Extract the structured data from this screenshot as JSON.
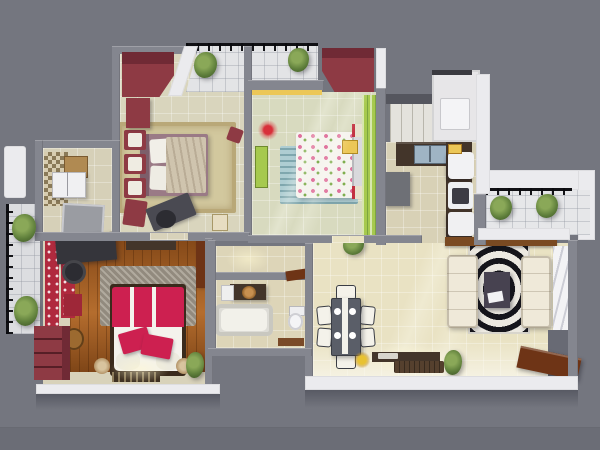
{
  "scene": {
    "title": "3D rendered top-down floor plan of a three-bedroom apartment",
    "background": "#74767f",
    "wall": "#84868f",
    "wall_white": "#ebebee",
    "rooms": {
      "bedroom1": {
        "label": "bedroom-1",
        "floor": "#d9d5bd",
        "furniture": [
          "maroon wardrobe",
          "double bed with beige patterned duvet",
          "floral rug",
          "accent chairs",
          "desk with office chair",
          "maroon cabinet"
        ]
      },
      "bedroom2": {
        "label": "bedroom-2",
        "floor": "#d8dabf",
        "furniture": [
          "maroon wardrobe",
          "white bed with pink flower print",
          "blue striped rug",
          "green bench",
          "green striped wardrobe",
          "nightstands",
          "yellow tray"
        ]
      },
      "kitchen": {
        "label": "kitchen",
        "floor": "#d8d1b6",
        "furniture": [
          "dark L-shaped counter",
          "double sink",
          "fridge",
          "oven",
          "cabinet",
          "grey table"
        ]
      },
      "utility": {
        "label": "utility-room",
        "floor": "#e7e6e8",
        "furniture": [
          "washing machine"
        ]
      },
      "foyer": {
        "label": "foyer-bathroom",
        "floor": "#d6d0b8",
        "furniture": [
          "mosaic wall",
          "white vanity",
          "wood cabinet",
          "shower tray"
        ]
      },
      "master": {
        "label": "master-bedroom",
        "floor": "#d8d2ba",
        "wood": "#a2591e",
        "furniture": [
          "red double bed",
          "grey shag rug",
          "maroon dresser",
          "wall TV panel",
          "red curtain panels",
          "log stools",
          "doormat",
          "plant"
        ]
      },
      "bathroom": {
        "label": "bathroom",
        "floor": "#ddd5b8",
        "furniture": [
          "bathtub",
          "toilet",
          "vanity with round basin",
          "brown mat"
        ]
      },
      "living": {
        "label": "living-dining",
        "floor": "#e9e2c3",
        "furniture": [
          "dining table with six chairs",
          "two cream sofas",
          "zebra rug",
          "coffee table",
          "TV console",
          "open entry door",
          "wavy curtains",
          "plants"
        ]
      },
      "balconyTop": {
        "label": "balcony-north",
        "floor": "#e3e4e6",
        "furniture": [
          "two plants",
          "railing"
        ]
      },
      "balconyLeft": {
        "label": "balcony-west",
        "floor": "#dcdde0",
        "furniture": [
          "two plants",
          "railing"
        ]
      },
      "balconyRight": {
        "label": "balcony-east",
        "floor": "#e6e7e9",
        "furniture": [
          "two plants",
          "railing"
        ]
      }
    },
    "colors": {
      "maroon": "#8e3a44",
      "maroonDark": "#702a35",
      "crimson": "#cd2050",
      "woodDark": "#43352a",
      "sofa": "#efe9d9",
      "tableGrey": "#5a5e68",
      "green": "#a6c94e",
      "plantGreen": "#5d7d3a",
      "yellow": "#ecc757",
      "doorBrown": "#6e3416",
      "steel": "#9fb4c4",
      "rugBeige": "#d2c89e",
      "rugBlue": "#aecdd2",
      "rugGrey": "#a29a8c",
      "curtainRed": "#b02a3e",
      "shelfBrown": "#7a4a22"
    }
  }
}
